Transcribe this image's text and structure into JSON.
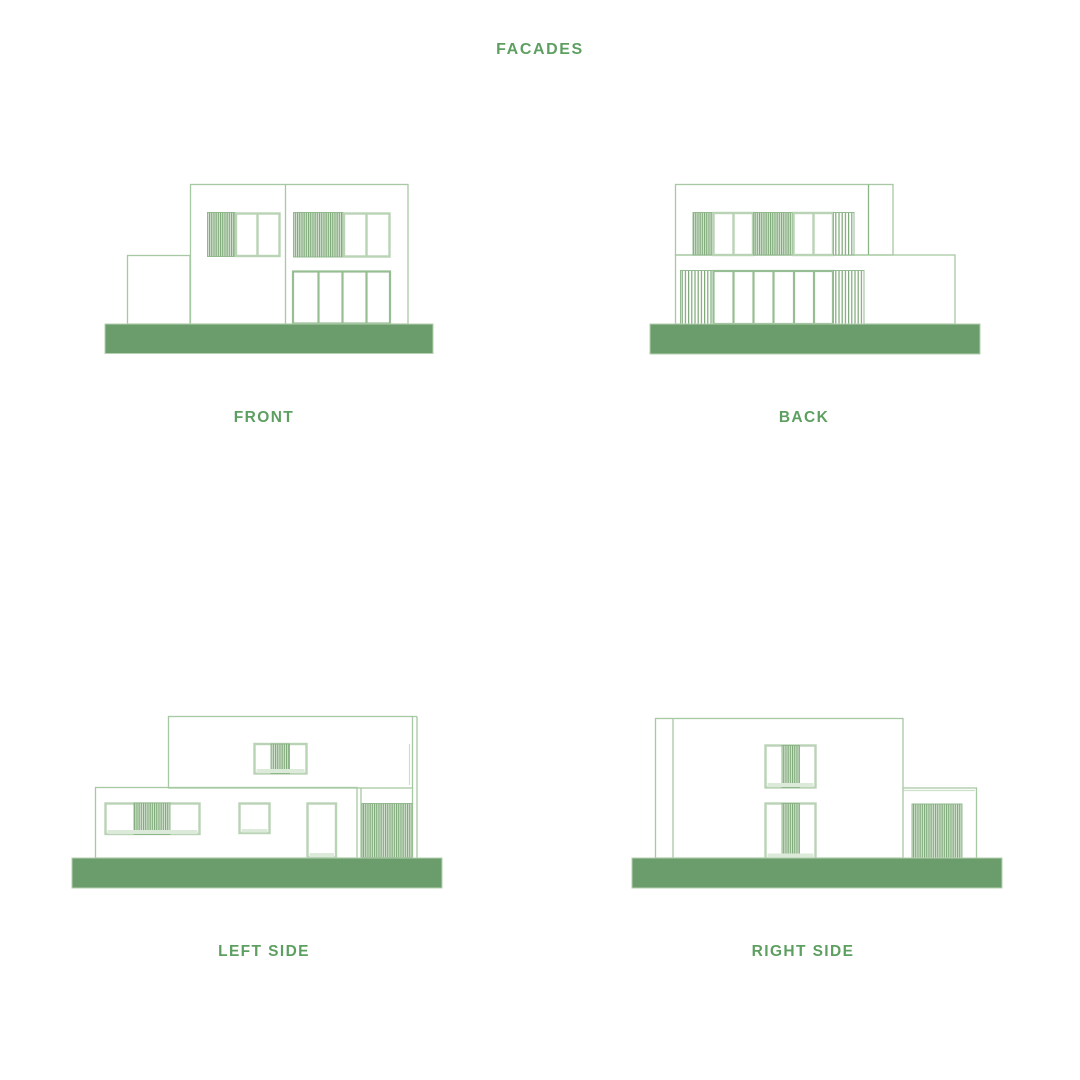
{
  "page": {
    "title": "FACADES"
  },
  "facades": [
    {
      "id": "front",
      "label": "FRONT"
    },
    {
      "id": "back",
      "label": "BACK"
    },
    {
      "id": "left-side",
      "label": "LEFT SIDE"
    },
    {
      "id": "right-side",
      "label": "RIGHT SIDE"
    }
  ],
  "colors": {
    "bg": "#ffffff",
    "text": "#5d9f61",
    "line": "#a6c8a2",
    "line_strong": "#8bb487",
    "line_light": "#cde0c9",
    "frame": "#b9d3b5",
    "mull": "#97bd92",
    "hatch_dark": "#7da878",
    "hatch_light": "#d7e5d3",
    "sill": "#dcead9",
    "ground": "#6b9c6b",
    "ground_edge": "#b5d0b2"
  }
}
